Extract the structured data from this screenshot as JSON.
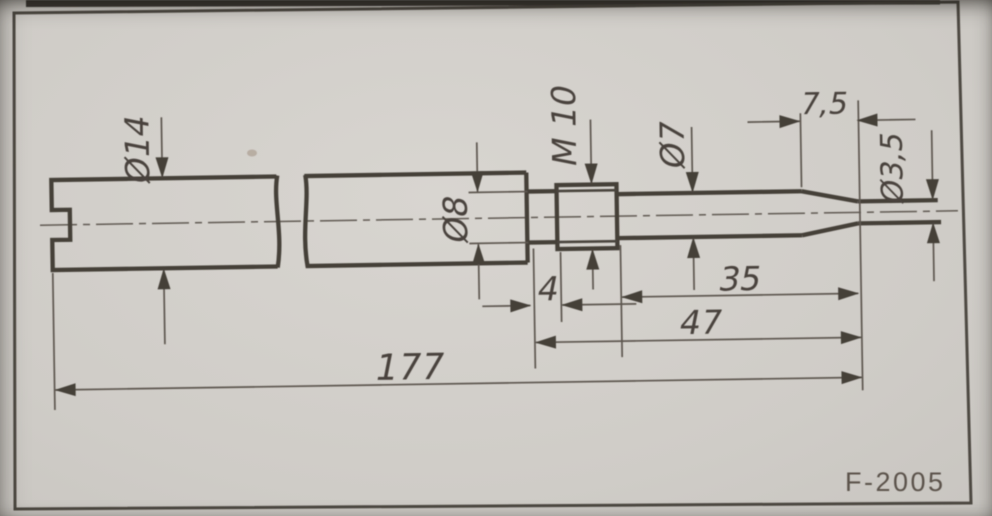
{
  "figure_code": "F-2005",
  "dimensions": {
    "shank_diameter": "Ø14",
    "neck_diameter": "Ø8",
    "thread": "M 10",
    "pilot_diameter": "Ø7",
    "tip_diameter": "Ø3,5",
    "tip_taper_length": "7,5",
    "neck_length": "4",
    "pilot_length": "35",
    "front_section_length": "47",
    "overall_length": "177"
  }
}
